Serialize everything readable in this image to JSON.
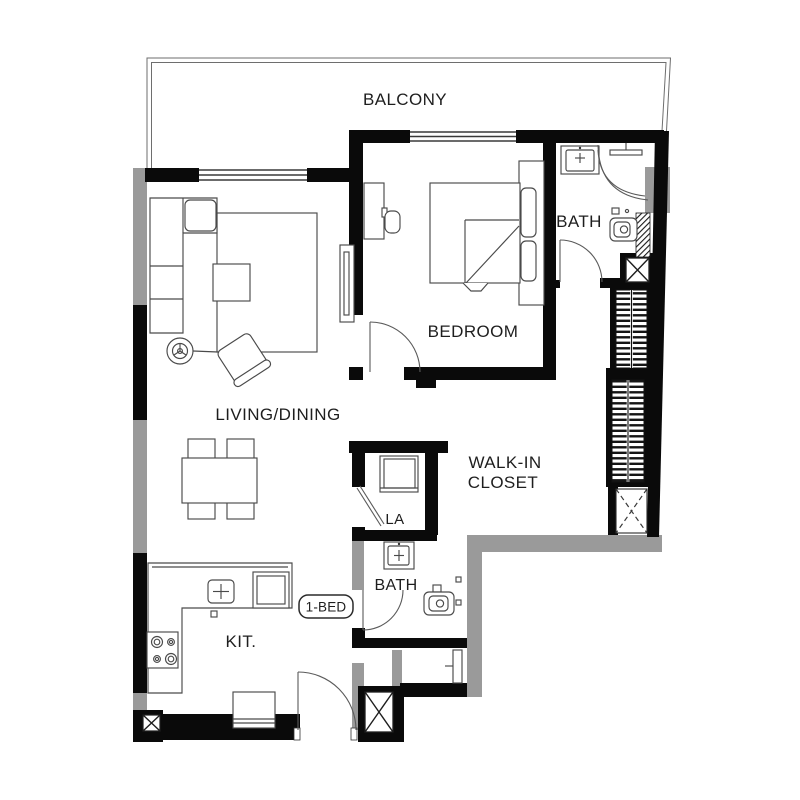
{
  "plan": {
    "type": "apartment-floor-plan",
    "badge": {
      "label": "1-BED"
    },
    "rooms": {
      "balcony": {
        "label": "BALCONY"
      },
      "bedroom": {
        "label": "BEDROOM"
      },
      "bath_upper": {
        "label": "BATH"
      },
      "living_dining": {
        "label": "LIVING/DINING"
      },
      "walk_in_closet": {
        "label_line1": "WALK-IN",
        "label_line2": "CLOSET"
      },
      "laundry": {
        "label": "LA"
      },
      "bath_lower": {
        "label": "BATH"
      },
      "kitchen": {
        "label": "KIT."
      }
    },
    "fixtures": [
      "sofa",
      "armchair",
      "floor-lamp",
      "coffee-table",
      "rug",
      "tv-unit",
      "dining-table",
      "dining-chairs",
      "bed",
      "pillows",
      "desk",
      "desk-chair",
      "kitchen-counter",
      "sink",
      "fridge",
      "stove",
      "washing-machine",
      "toilet",
      "shower",
      "wardrobe-shelving",
      "service-shaft",
      "entry-cabinet"
    ]
  },
  "colors": {
    "wall": "#0a0a0a",
    "exterior_column": "#9a9a9a",
    "furniture_line": "#4a4a4a",
    "text": "#1e1e1e",
    "background": "#ffffff"
  }
}
